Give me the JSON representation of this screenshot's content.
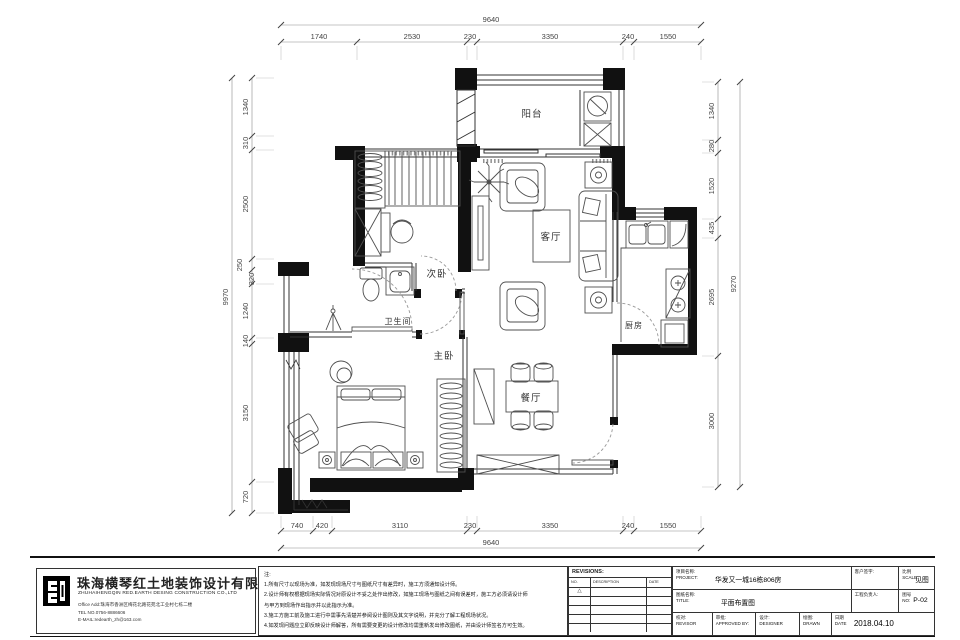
{
  "plan": {
    "rooms": {
      "balcony": "阳台",
      "living": "客厅",
      "bedroom2": "次卧",
      "bathroom": "卫生间",
      "master": "主卧",
      "dining": "餐厅",
      "kitchen": "厨房"
    },
    "dims": {
      "top": {
        "total": "9640",
        "segments": [
          "1740",
          "2530",
          "230",
          "3350",
          "240",
          "1550"
        ]
      },
      "bottom": {
        "total": "9640",
        "segments": [
          "740",
          "420",
          "3110",
          "230",
          "3350",
          "240",
          "1550"
        ]
      },
      "left": {
        "total": "9970",
        "segments": [
          "1340",
          "310",
          "2500",
          "250",
          "320",
          "1240",
          "140",
          "3150",
          "720"
        ]
      },
      "right": {
        "total": "9270",
        "segments": [
          "1340",
          "280",
          "1520",
          "435",
          "2695",
          "3000"
        ]
      }
    }
  },
  "company": {
    "name_cn": "珠海横琴红土地装饰设计有限公司",
    "name_en": "ZHUHAIHENGQIN RED.EARTH DESING CONSTRUCTION CO.,LTD",
    "address": "Office Add:珠海市香洲区梅花北路花苑北工业村七栋二楼",
    "tel": "TEL NO.0756-8886606",
    "email": "E-MAIL:redearth_zh@163.com"
  },
  "notes": {
    "lines": [
      "注:",
      "1.所有尺寸以现场为准，如发现现场尺寸与图纸尺寸有差异时，施工方须通知设计师。",
      "2.设计师有权根据现场实际情况对原设计不妥之处作出修改，如施工现场与图纸之间有误差时，施工方必须请设计师",
      "与甲方到现场作出指示并以此指示为准。",
      "3.施工方施工前及施工进行中需事先清楚并参阅设计图则及其文字说明，并充分了解工程现场状况。",
      "4.如发现问题应立即反映设计师解答，所有需要变更的设计修改均需重新发出修改图纸，并由设计师签名方可生效。"
    ]
  },
  "revisions": {
    "header": "REVISIONS:",
    "col_no": "NO.",
    "col_desc": "DESCRIPTION",
    "col_date": "DATE",
    "marker": "△"
  },
  "titleblock": {
    "project_label_cn": "项目名称:",
    "project_label_en": "PROJECT:",
    "project_value": "华发又一城16栋806房",
    "client_sign_label": "客户签字:",
    "scale_label_cn": "比例",
    "scale_label_en": "SCALE:",
    "scale_value": "见图",
    "title_label_cn": "图纸名称:",
    "title_label_en": "TITLE:",
    "title_value": "平面布置图",
    "manager_label": "工程负责人:",
    "no_label_cn": "图号",
    "no_label_en": "NO:",
    "no_value": "P-02",
    "check_label_cn": "校对:",
    "check_label_en": "REVISOR",
    "approve_label_cn": "审批:",
    "approve_label_en": "APPROVED BY:",
    "design_label_cn": "设计:",
    "design_label_en": "DESIGNER",
    "drawn_label_cn": "绘图:",
    "drawn_label_en": "DRAWN",
    "date_label_cn": "日期",
    "date_label_en": "DATE",
    "date_value": "2018.04.10"
  }
}
